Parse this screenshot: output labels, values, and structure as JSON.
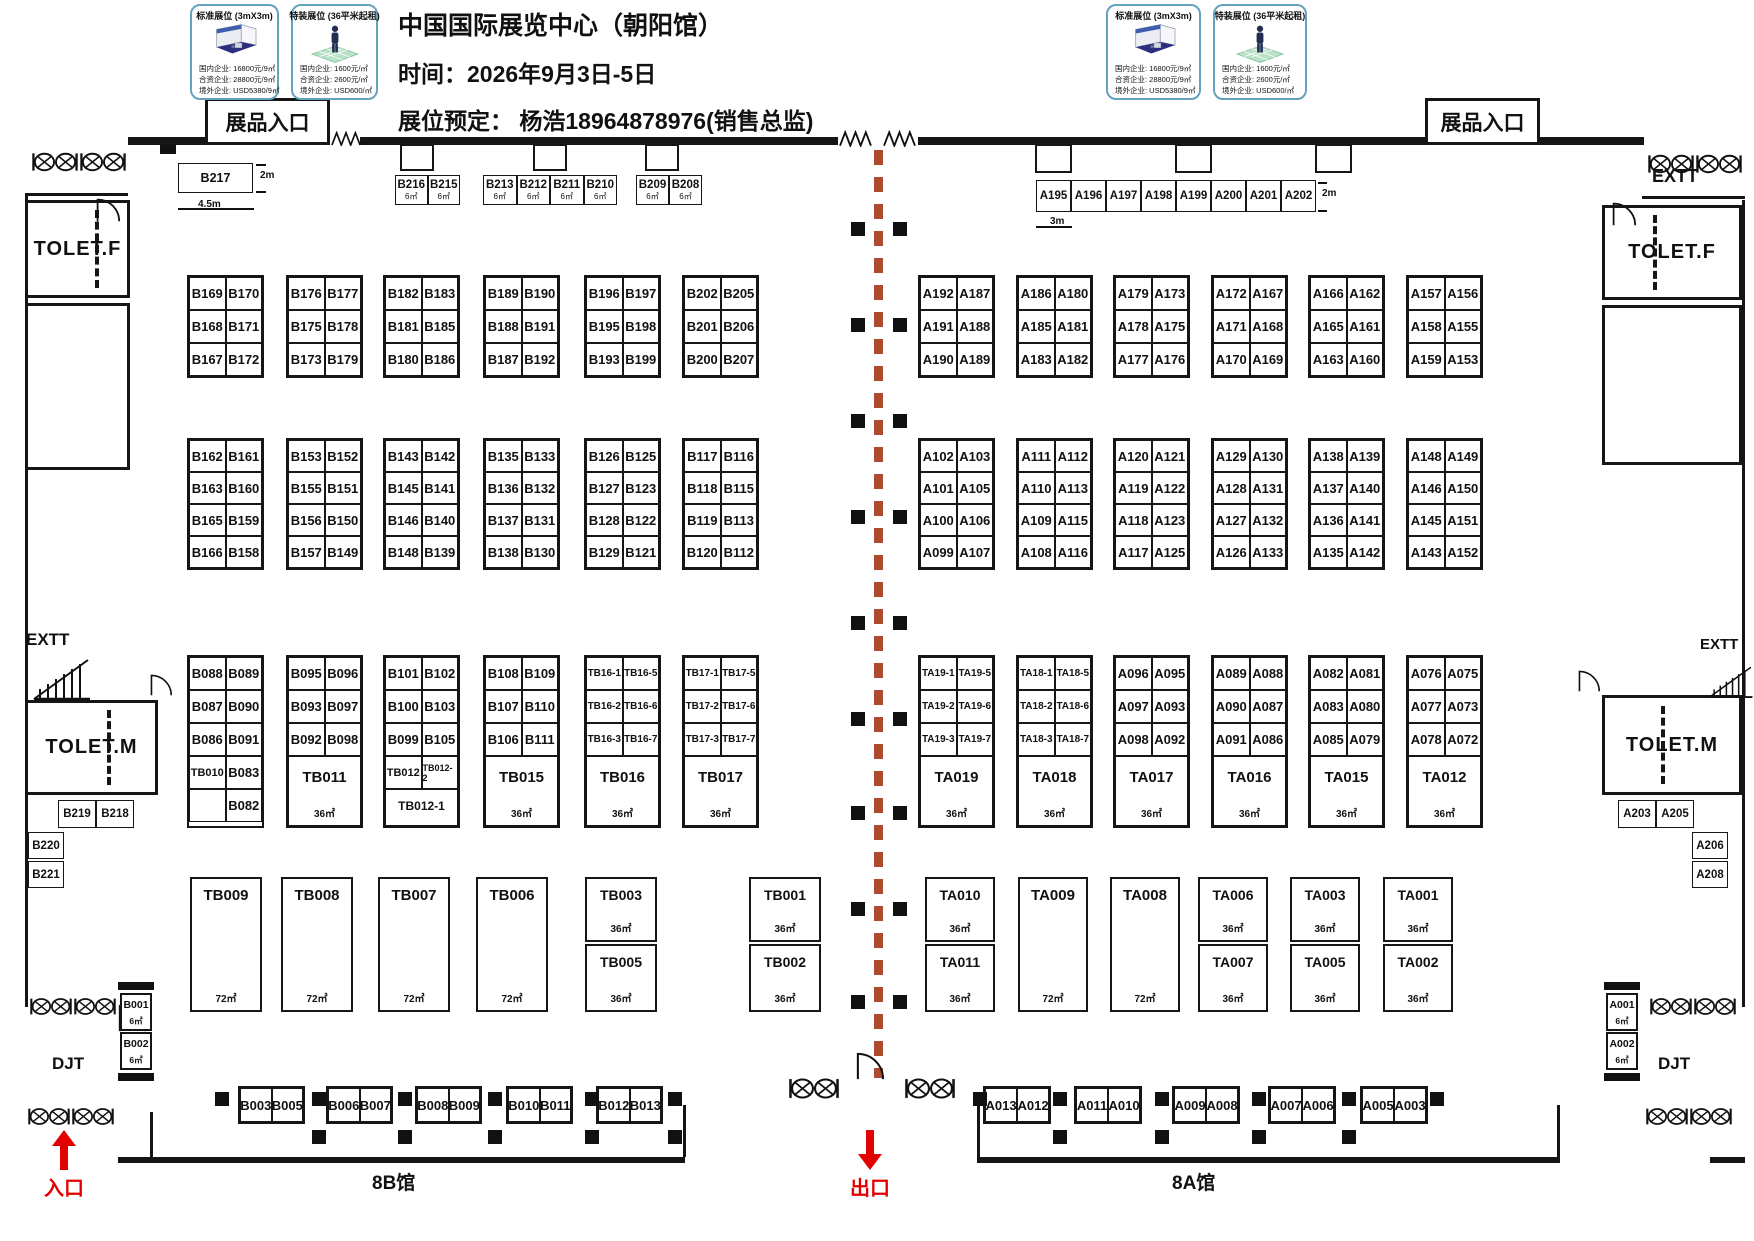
{
  "title": {
    "line1": "中国国际展览中心（朝阳馆）",
    "line2": "时间：2026年9月3日-5日",
    "line3": "展位预定：  杨浩18964878976(销售总监)"
  },
  "legend": {
    "standard": {
      "title": "标准展位 (3mX3m)",
      "prices": [
        "国内企业: 16800元/9㎡",
        "合资企业: 28800元/9㎡",
        "境外企业: USD5380/9㎡"
      ]
    },
    "special": {
      "title": "特装展位 (36平米起租)",
      "prices": [
        "国内企业: 1600元/㎡",
        "合资企业: 2600元/㎡",
        "境外企业: USD600/㎡"
      ]
    }
  },
  "labels": {
    "exhibitEntrance": "展品入口",
    "toiletF": "TOLET.F",
    "toiletM": "TOLET.M",
    "exitStair": "EXTT",
    "djt": "DJT",
    "entrance": "入口",
    "exit": "出口",
    "hall8B": "8B馆",
    "hall8A": "8A馆"
  },
  "dims": {
    "b217Depth": "2m",
    "b217Width": "4.5m",
    "aStripDepth": "2m",
    "aStripWidth": "3m"
  },
  "booths": {
    "b217": "B217",
    "topBGroups": [
      {
        "cells": [
          "B216",
          "B215"
        ],
        "area": "6㎡"
      },
      {
        "cells": [
          "B213",
          "B212",
          "B211",
          "B210"
        ],
        "area": "6㎡"
      },
      {
        "cells": [
          "B209",
          "B208"
        ],
        "area": "6㎡"
      }
    ],
    "topAStrip": [
      "A195",
      "A196",
      "A197",
      "A198",
      "A199",
      "A200",
      "A201",
      "A202"
    ],
    "row1Left": [
      [
        [
          "B169",
          "B170"
        ],
        [
          "B168",
          "B171"
        ],
        [
          "B167",
          "B172"
        ]
      ],
      [
        [
          "B176",
          "B177"
        ],
        [
          "B175",
          "B178"
        ],
        [
          "B173",
          "B179"
        ]
      ],
      [
        [
          "B182",
          "B183"
        ],
        [
          "B181",
          "B185"
        ],
        [
          "B180",
          "B186"
        ]
      ],
      [
        [
          "B189",
          "B190"
        ],
        [
          "B188",
          "B191"
        ],
        [
          "B187",
          "B192"
        ]
      ],
      [
        [
          "B196",
          "B197"
        ],
        [
          "B195",
          "B198"
        ],
        [
          "B193",
          "B199"
        ]
      ],
      [
        [
          "B202",
          "B205"
        ],
        [
          "B201",
          "B206"
        ],
        [
          "B200",
          "B207"
        ]
      ]
    ],
    "row1Right": [
      [
        [
          "A192",
          "A187"
        ],
        [
          "A191",
          "A188"
        ],
        [
          "A190",
          "A189"
        ]
      ],
      [
        [
          "A186",
          "A180"
        ],
        [
          "A185",
          "A181"
        ],
        [
          "A183",
          "A182"
        ]
      ],
      [
        [
          "A179",
          "A173"
        ],
        [
          "A178",
          "A175"
        ],
        [
          "A177",
          "A176"
        ]
      ],
      [
        [
          "A172",
          "A167"
        ],
        [
          "A171",
          "A168"
        ],
        [
          "A170",
          "A169"
        ]
      ],
      [
        [
          "A166",
          "A162"
        ],
        [
          "A165",
          "A161"
        ],
        [
          "A163",
          "A160"
        ]
      ],
      [
        [
          "A157",
          "A156"
        ],
        [
          "A158",
          "A155"
        ],
        [
          "A159",
          "A153"
        ]
      ]
    ],
    "row2Left": [
      [
        [
          "B162",
          "B161"
        ],
        [
          "B163",
          "B160"
        ],
        [
          "B165",
          "B159"
        ],
        [
          "B166",
          "B158"
        ]
      ],
      [
        [
          "B153",
          "B152"
        ],
        [
          "B155",
          "B151"
        ],
        [
          "B156",
          "B150"
        ],
        [
          "B157",
          "B149"
        ]
      ],
      [
        [
          "B143",
          "B142"
        ],
        [
          "B145",
          "B141"
        ],
        [
          "B146",
          "B140"
        ],
        [
          "B148",
          "B139"
        ]
      ],
      [
        [
          "B135",
          "B133"
        ],
        [
          "B136",
          "B132"
        ],
        [
          "B137",
          "B131"
        ],
        [
          "B138",
          "B130"
        ]
      ],
      [
        [
          "B126",
          "B125"
        ],
        [
          "B127",
          "B123"
        ],
        [
          "B128",
          "B122"
        ],
        [
          "B129",
          "B121"
        ]
      ],
      [
        [
          "B117",
          "B116"
        ],
        [
          "B118",
          "B115"
        ],
        [
          "B119",
          "B113"
        ],
        [
          "B120",
          "B112"
        ]
      ]
    ],
    "row2Right": [
      [
        [
          "A102",
          "A103"
        ],
        [
          "A101",
          "A105"
        ],
        [
          "A100",
          "A106"
        ],
        [
          "A099",
          "A107"
        ]
      ],
      [
        [
          "A111",
          "A112"
        ],
        [
          "A110",
          "A113"
        ],
        [
          "A109",
          "A115"
        ],
        [
          "A108",
          "A116"
        ]
      ],
      [
        [
          "A120",
          "A121"
        ],
        [
          "A119",
          "A122"
        ],
        [
          "A118",
          "A123"
        ],
        [
          "A117",
          "A125"
        ]
      ],
      [
        [
          "A129",
          "A130"
        ],
        [
          "A128",
          "A131"
        ],
        [
          "A127",
          "A132"
        ],
        [
          "A126",
          "A133"
        ]
      ],
      [
        [
          "A138",
          "A139"
        ],
        [
          "A137",
          "A140"
        ],
        [
          "A136",
          "A141"
        ],
        [
          "A135",
          "A142"
        ]
      ],
      [
        [
          "A148",
          "A149"
        ],
        [
          "A146",
          "A150"
        ],
        [
          "A145",
          "A151"
        ],
        [
          "A143",
          "A152"
        ]
      ]
    ],
    "row3Left": [
      {
        "cells": [
          [
            "B088",
            "B089"
          ],
          [
            "B087",
            "B090"
          ],
          [
            "B086",
            "B091"
          ],
          [
            "TB010",
            "B083"
          ],
          [
            "",
            "B082"
          ]
        ]
      },
      {
        "cells": [
          [
            "B095",
            "B096"
          ],
          [
            "B093",
            "B097"
          ],
          [
            "B092",
            "B098"
          ]
        ],
        "footer": {
          "name": "TB011",
          "area": "36㎡"
        }
      },
      {
        "cells": [
          [
            "B101",
            "B102"
          ],
          [
            "B100",
            "B103"
          ],
          [
            "B099",
            "B105"
          ],
          [
            "TB012",
            "TB012-2"
          ]
        ],
        "footer": {
          "name": "TB012-1",
          "area": ""
        }
      },
      {
        "cells": [
          [
            "B108",
            "B109"
          ],
          [
            "B107",
            "B110"
          ],
          [
            "B106",
            "B111"
          ]
        ],
        "footer": {
          "name": "TB015",
          "area": "36㎡"
        }
      },
      {
        "cells": [
          [
            "TB16-1",
            "TB16-5"
          ],
          [
            "TB16-2",
            "TB16-6"
          ],
          [
            "TB16-3",
            "TB16-7"
          ]
        ],
        "footer": {
          "name": "TB016",
          "area": "36㎡"
        }
      },
      {
        "cells": [
          [
            "TB17-1",
            "TB17-5"
          ],
          [
            "TB17-2",
            "TB17-6"
          ],
          [
            "TB17-3",
            "TB17-7"
          ]
        ],
        "footer": {
          "name": "TB017",
          "area": "36㎡"
        }
      }
    ],
    "row3Right": [
      {
        "cells": [
          [
            "TA19-1",
            "TA19-5"
          ],
          [
            "TA19-2",
            "TA19-6"
          ],
          [
            "TA19-3",
            "TA19-7"
          ]
        ],
        "footer": {
          "name": "TA019",
          "area": "36㎡"
        }
      },
      {
        "cells": [
          [
            "TA18-1",
            "TA18-5"
          ],
          [
            "TA18-2",
            "TA18-6"
          ],
          [
            "TA18-3",
            "TA18-7"
          ]
        ],
        "footer": {
          "name": "TA018",
          "area": "36㎡"
        }
      },
      {
        "cells": [
          [
            "A096",
            "A095"
          ],
          [
            "A097",
            "A093"
          ],
          [
            "A098",
            "A092"
          ]
        ],
        "footer": {
          "name": "TA017",
          "area": "36㎡"
        }
      },
      {
        "cells": [
          [
            "A089",
            "A088"
          ],
          [
            "A090",
            "A087"
          ],
          [
            "A091",
            "A086"
          ]
        ],
        "footer": {
          "name": "TA016",
          "area": "36㎡"
        }
      },
      {
        "cells": [
          [
            "A082",
            "A081"
          ],
          [
            "A083",
            "A080"
          ],
          [
            "A085",
            "A079"
          ]
        ],
        "footer": {
          "name": "TA015",
          "area": "36㎡"
        }
      },
      {
        "cells": [
          [
            "A076",
            "A075"
          ],
          [
            "A077",
            "A073"
          ],
          [
            "A078",
            "A072"
          ]
        ],
        "footer": {
          "name": "TA012",
          "area": "36㎡"
        }
      }
    ],
    "row4Left": [
      {
        "name": "TB009",
        "area": "72㎡"
      },
      {
        "name": "TB008",
        "area": "72㎡"
      },
      {
        "name": "TB007",
        "area": "72㎡"
      },
      {
        "name": "TB006",
        "area": "72㎡"
      },
      {
        "stack": [
          {
            "name": "TB003",
            "area": "36㎡"
          },
          {
            "name": "TB005",
            "area": "36㎡"
          }
        ]
      },
      {
        "stack": [
          {
            "name": "TB001",
            "area": "36㎡"
          },
          {
            "name": "TB002",
            "area": "36㎡"
          }
        ]
      }
    ],
    "row4Right": [
      {
        "stack": [
          {
            "name": "TA010",
            "area": "36㎡"
          },
          {
            "name": "TA011",
            "area": "36㎡"
          }
        ]
      },
      {
        "name": "TA009",
        "area": "72㎡"
      },
      {
        "name": "TA008",
        "area": "72㎡"
      },
      {
        "stack": [
          {
            "name": "TA006",
            "area": "36㎡"
          },
          {
            "name": "TA007",
            "area": "36㎡"
          }
        ]
      },
      {
        "stack": [
          {
            "name": "TA003",
            "area": "36㎡"
          },
          {
            "name": "TA005",
            "area": "36㎡"
          }
        ]
      },
      {
        "stack": [
          {
            "name": "TA001",
            "area": "36㎡"
          },
          {
            "name": "TA002",
            "area": "36㎡"
          }
        ]
      }
    ],
    "bottomLeft": [
      [
        "B003",
        "B005"
      ],
      [
        "B006",
        "B007"
      ],
      [
        "B008",
        "B009"
      ],
      [
        "B010",
        "B011"
      ],
      [
        "B012",
        "B013"
      ]
    ],
    "bottomRight": [
      [
        "A013",
        "A012"
      ],
      [
        "A011",
        "A010"
      ],
      [
        "A009",
        "A008"
      ],
      [
        "A007",
        "A006"
      ],
      [
        "A005",
        "A003"
      ]
    ],
    "edgeLeft": {
      "pair": [
        "B219",
        "B218"
      ],
      "single1": "B220",
      "single2": "B221",
      "stack": [
        {
          "name": "B001",
          "area": "6㎡"
        },
        {
          "name": "B002",
          "area": "6㎡"
        }
      ]
    },
    "edgeRight": {
      "pair": [
        "A203",
        "A205"
      ],
      "single1": "A206",
      "single2": "A208",
      "stack": [
        {
          "name": "A001",
          "area": "6㎡"
        },
        {
          "name": "A002",
          "area": "6㎡"
        }
      ]
    }
  }
}
